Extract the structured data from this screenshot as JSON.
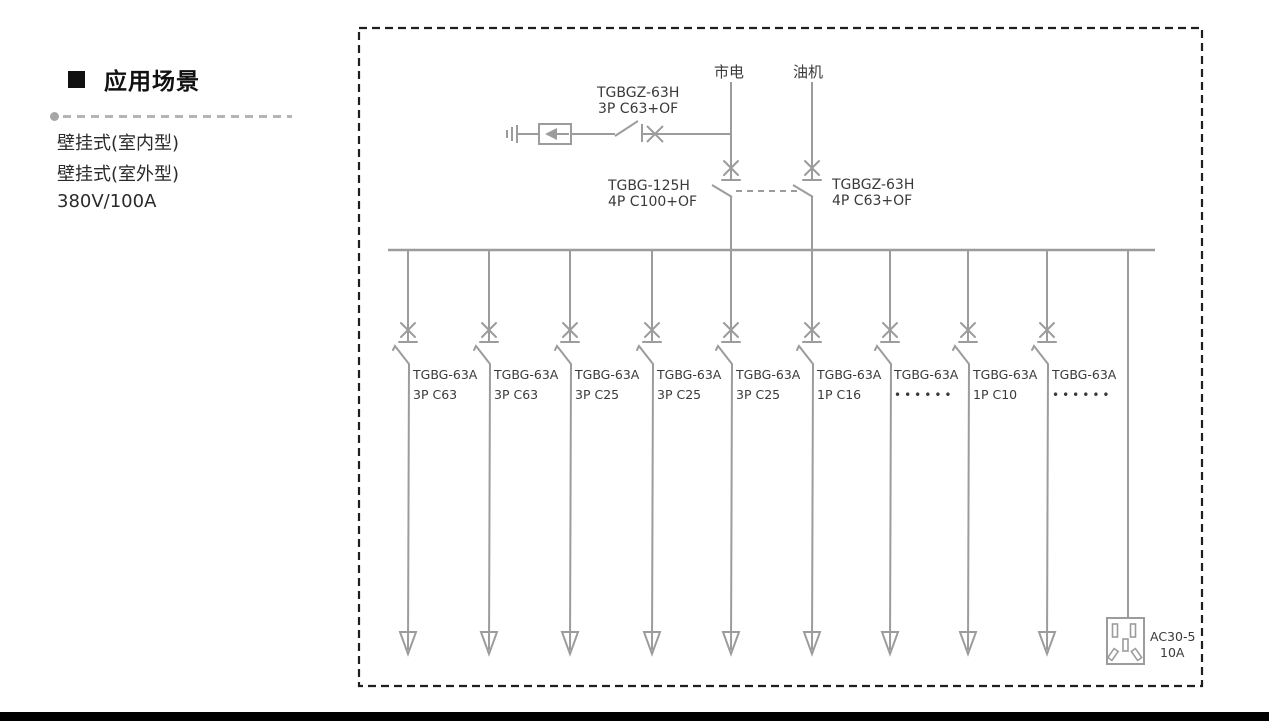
{
  "sidebar": {
    "heading": "应用场景",
    "items": [
      "壁挂式(室内型)",
      "壁挂式(室外型)",
      "380V/100A"
    ]
  },
  "diagram": {
    "colors": {
      "line": "#9c9c9c",
      "text": "#3a3a3a",
      "border": "#1f1f1f",
      "bottom_bar": "#000000"
    },
    "sources": {
      "mains": "市电",
      "generator": "油机"
    },
    "surge_branch": {
      "model": "TGBGZ-63H",
      "rating": "3P C63+OF"
    },
    "main_breaker_left": {
      "model": "TGBG-125H",
      "rating": "4P C100+OF"
    },
    "main_breaker_right": {
      "model": "TGBGZ-63H",
      "rating": "4P C63+OF"
    },
    "feeders": [
      {
        "model": "TGBG-63A",
        "rating": "3P C63"
      },
      {
        "model": "TGBG-63A",
        "rating": "3P C63"
      },
      {
        "model": "TGBG-63A",
        "rating": "3P C25"
      },
      {
        "model": "TGBG-63A",
        "rating": "3P C25"
      },
      {
        "model": "TGBG-63A",
        "rating": "3P C25"
      },
      {
        "model": "TGBG-63A",
        "rating": "1P C16"
      },
      {
        "model": "TGBG-63A",
        "rating": "••••••"
      },
      {
        "model": "TGBG-63A",
        "rating": "1P C10"
      },
      {
        "model": "TGBG-63A",
        "rating": "••••••"
      }
    ],
    "socket": {
      "model": "AC30-5",
      "rating": "10A"
    }
  }
}
